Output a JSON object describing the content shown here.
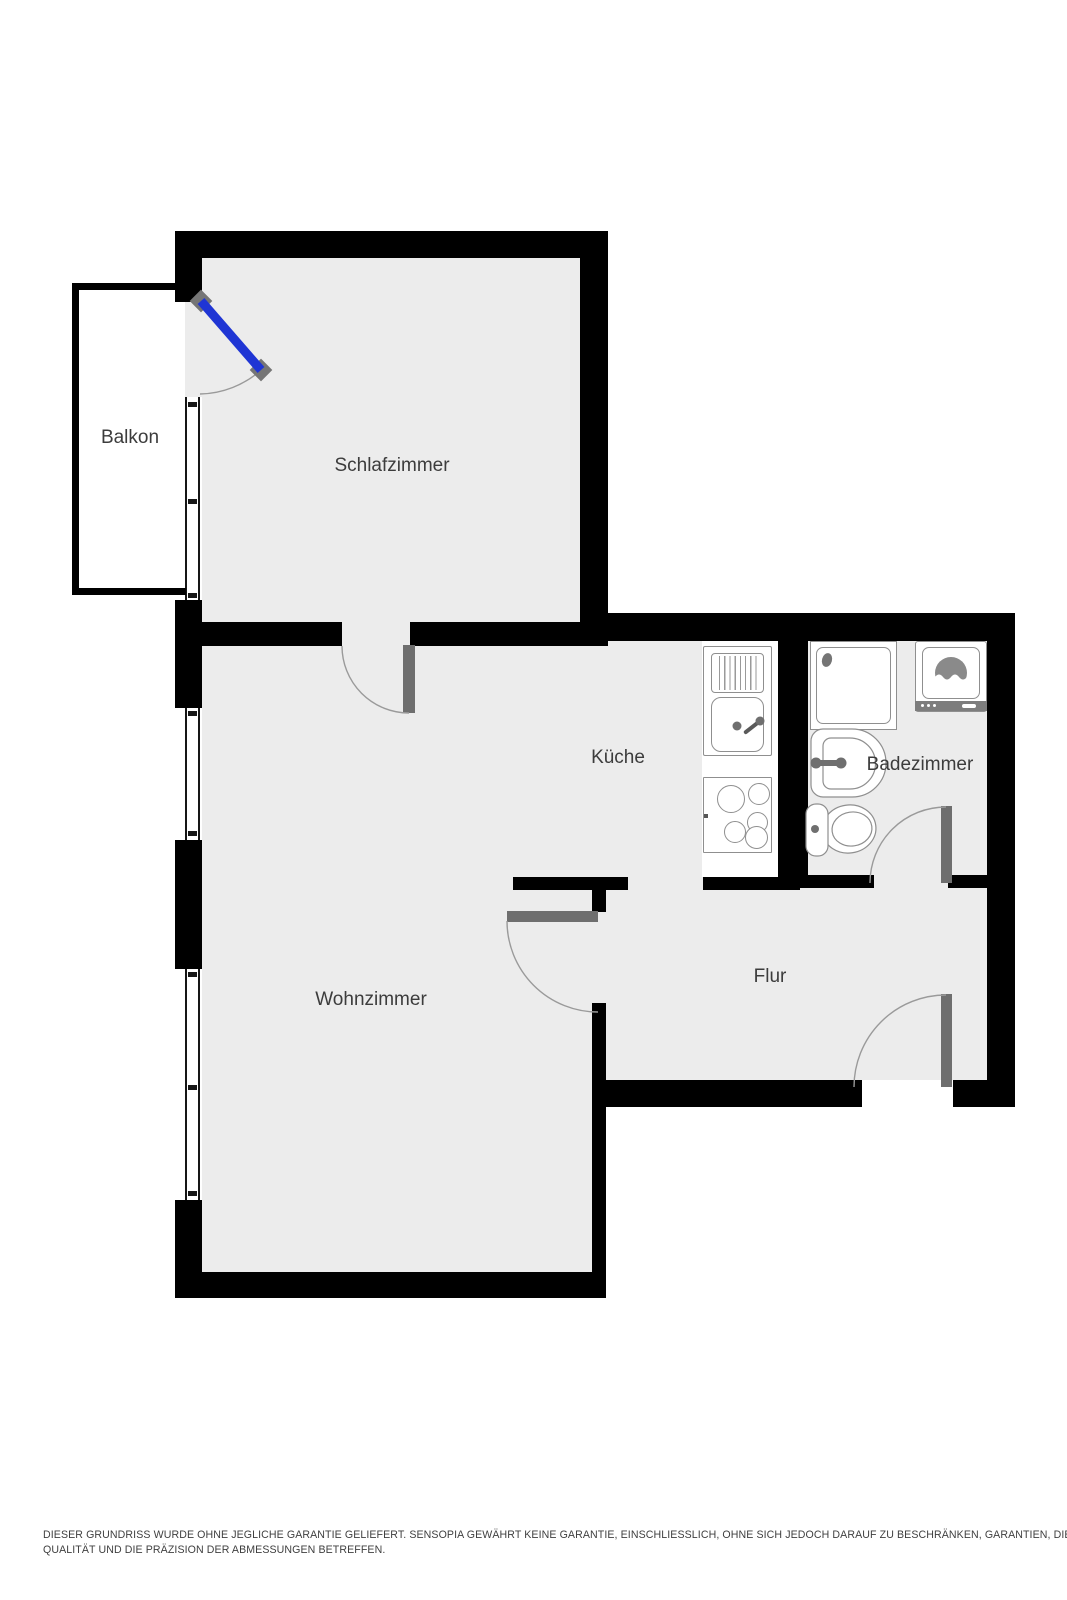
{
  "rooms": [
    {
      "id": "balkon",
      "label": "Balkon"
    },
    {
      "id": "schlafzimmer",
      "label": "Schlafzimmer"
    },
    {
      "id": "kueche",
      "label": "Küche"
    },
    {
      "id": "badezimmer",
      "label": "Badezimmer"
    },
    {
      "id": "wohnzimmer",
      "label": "Wohnzimmer"
    },
    {
      "id": "flur",
      "label": "Flur"
    }
  ],
  "disclaimer": {
    "line1": "DIESER GRUNDRISS WURDE OHNE JEGLICHE GARANTIE GELIEFERT. SENSOPIA GEWÄHRT KEINE GARANTIE, EINSCHLIESSLICH, OHNE SICH JEDOCH DARAUF ZU BESCHRÄNKEN, GARANTIEN, DIE DIE",
    "line2": "QUALITÄT UND DIE PRÄZISION DER ABMESSUNGEN BETREFFEN."
  },
  "colors": {
    "background": "#ffffff",
    "wall": "#000000",
    "floor": "#ececec",
    "door_leaf": "#6e6e6e",
    "hinge": "#757575",
    "balcony_door_blue": "#1f35d4",
    "fixture_outline": "#8f8f8f",
    "fixture_fill": "#ffffff",
    "drum": "#8a8a8a",
    "arc": "#9a9a9a",
    "label_text": "#3c3c3c",
    "disclaimer_text": "#3f3f3f"
  }
}
